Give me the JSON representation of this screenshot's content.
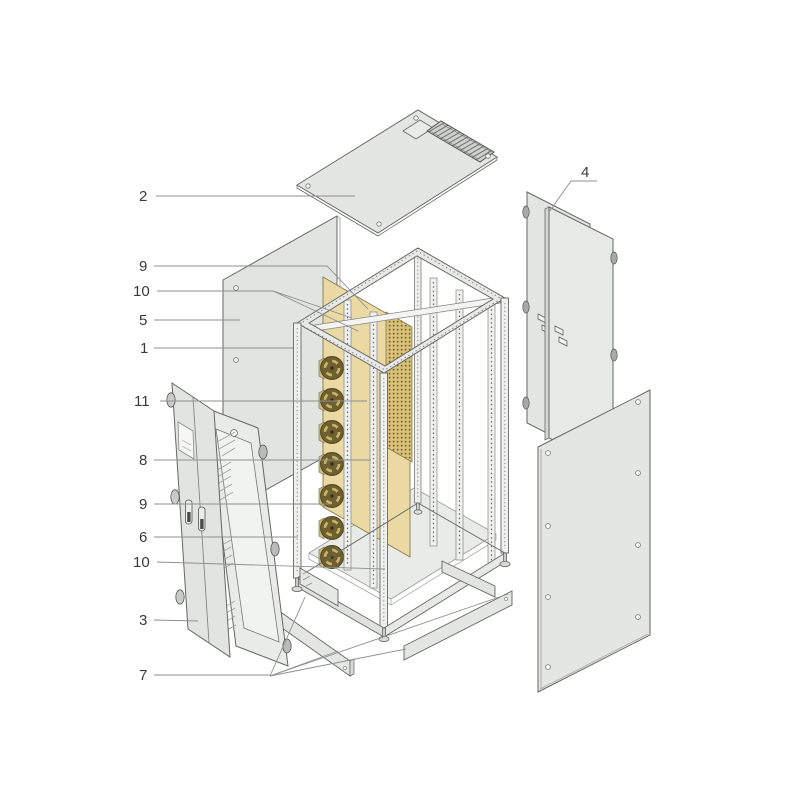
{
  "figure": {
    "type": "exploded-parts-diagram",
    "subject": "rack-cabinet-enclosure",
    "background": "#ffffff",
    "colors": {
      "line": "#666666",
      "leader": "#8f8f8f",
      "label": "#3a3a3a",
      "panel": "#e4e6e3",
      "panel_light": "#eceeeb",
      "glass": "#f3f5f2",
      "yellow_panel": "#ead9a2",
      "patch_band": "#d9c37b",
      "fan_dark": "#6e5f2e",
      "fan_blade": "#c8b567"
    },
    "callouts": [
      {
        "label": "2",
        "text_x": 139,
        "text_y": 201,
        "lines": [
          "156,196 355,196"
        ]
      },
      {
        "label": "9",
        "text_x": 139,
        "text_y": 271,
        "lines": [
          "154,266 327,266 368,309"
        ]
      },
      {
        "label": "10",
        "text_x": 133,
        "text_y": 296,
        "lines": [
          "157,291 273,291 352,318",
          "273,291 358,331"
        ]
      },
      {
        "label": "5",
        "text_x": 139,
        "text_y": 325,
        "lines": [
          "154,320 240,320"
        ]
      },
      {
        "label": "1",
        "text_x": 140,
        "text_y": 353,
        "lines": [
          "154,348 293,348"
        ]
      },
      {
        "label": "11",
        "text_x": 134,
        "text_y": 406,
        "lines": [
          "160,401 367,401"
        ]
      },
      {
        "label": "8",
        "text_x": 139,
        "text_y": 465,
        "lines": [
          "154,460 371,460"
        ]
      },
      {
        "label": "9",
        "text_x": 139,
        "text_y": 509,
        "lines": [
          "154,504 330,504"
        ]
      },
      {
        "label": "6",
        "text_x": 139,
        "text_y": 542,
        "lines": [
          "154,537 298,537"
        ]
      },
      {
        "label": "10",
        "text_x": 133,
        "text_y": 567,
        "lines": [
          "157,562 385,569"
        ]
      },
      {
        "label": "3",
        "text_x": 139,
        "text_y": 625,
        "lines": [
          "154,620 198,621"
        ]
      },
      {
        "label": "7",
        "text_x": 139,
        "text_y": 680,
        "lines": [
          "154,675 270,675",
          "270,676 305,597",
          "270,676 338,651",
          "270,676 406,649",
          "270,676 508,594"
        ]
      },
      {
        "label": "4",
        "text_x": 581,
        "text_y": 177,
        "lines": [
          "597,181 571,181 549,212"
        ]
      }
    ]
  }
}
